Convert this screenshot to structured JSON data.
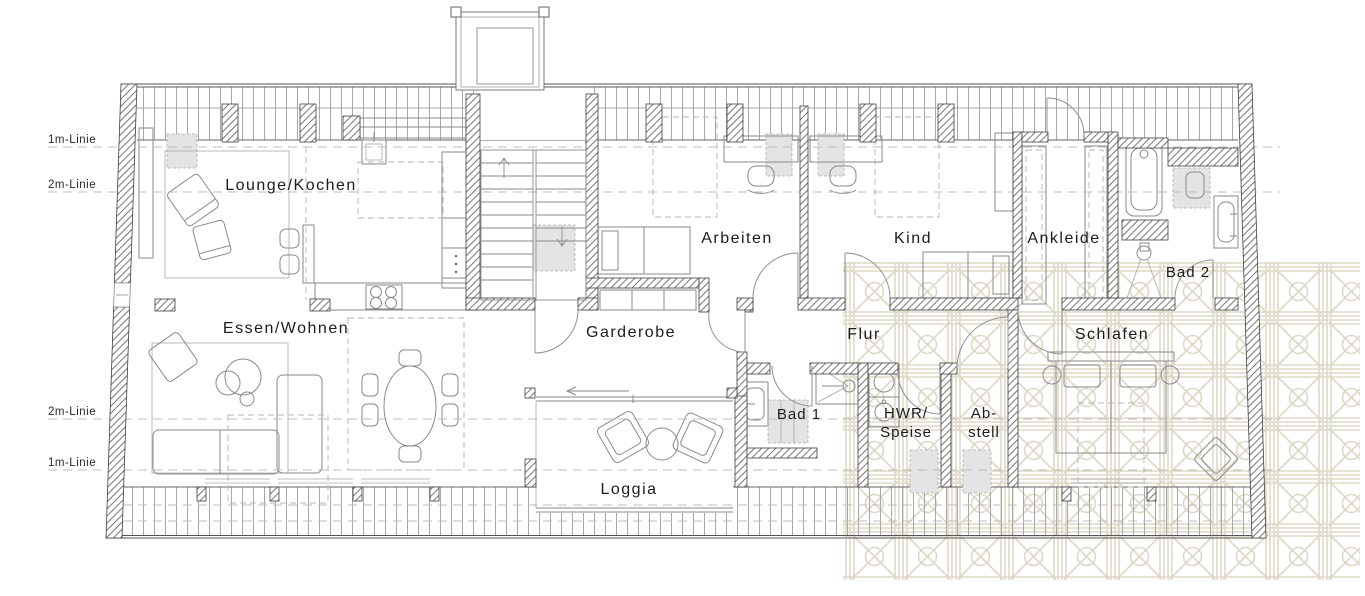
{
  "plan": {
    "reference_lines": {
      "top_1m": "1m-Linie",
      "top_2m": "2m-Linie",
      "bottom_2m": "2m-Linie",
      "bottom_1m": "1m-Linie"
    },
    "rooms": {
      "lounge_kochen": "Lounge/Kochen",
      "essen_wohnen": "Essen/Wohnen",
      "garderobe": "Garderobe",
      "arbeiten": "Arbeiten",
      "kind": "Kind",
      "ankleide": "Ankleide",
      "bad2": "Bad 2",
      "flur": "Flur",
      "schlafen": "Schlafen",
      "bad1": "Bad 1",
      "hwr_line1": "HWR/",
      "hwr_line2": "Speise",
      "abstell_line1": "Ab-",
      "abstell_line2": "stell",
      "loggia": "Loggia"
    },
    "colors": {
      "background": "#ffffff",
      "wall_hatch": "#7a7a7a",
      "outline": "#3f3f3f",
      "furniture_line": "#8a8a8a",
      "dashed_guide": "#bcbcbc",
      "skylight_fill": "#e4e4e4",
      "lattice_pattern": "#ddd8c6"
    }
  }
}
